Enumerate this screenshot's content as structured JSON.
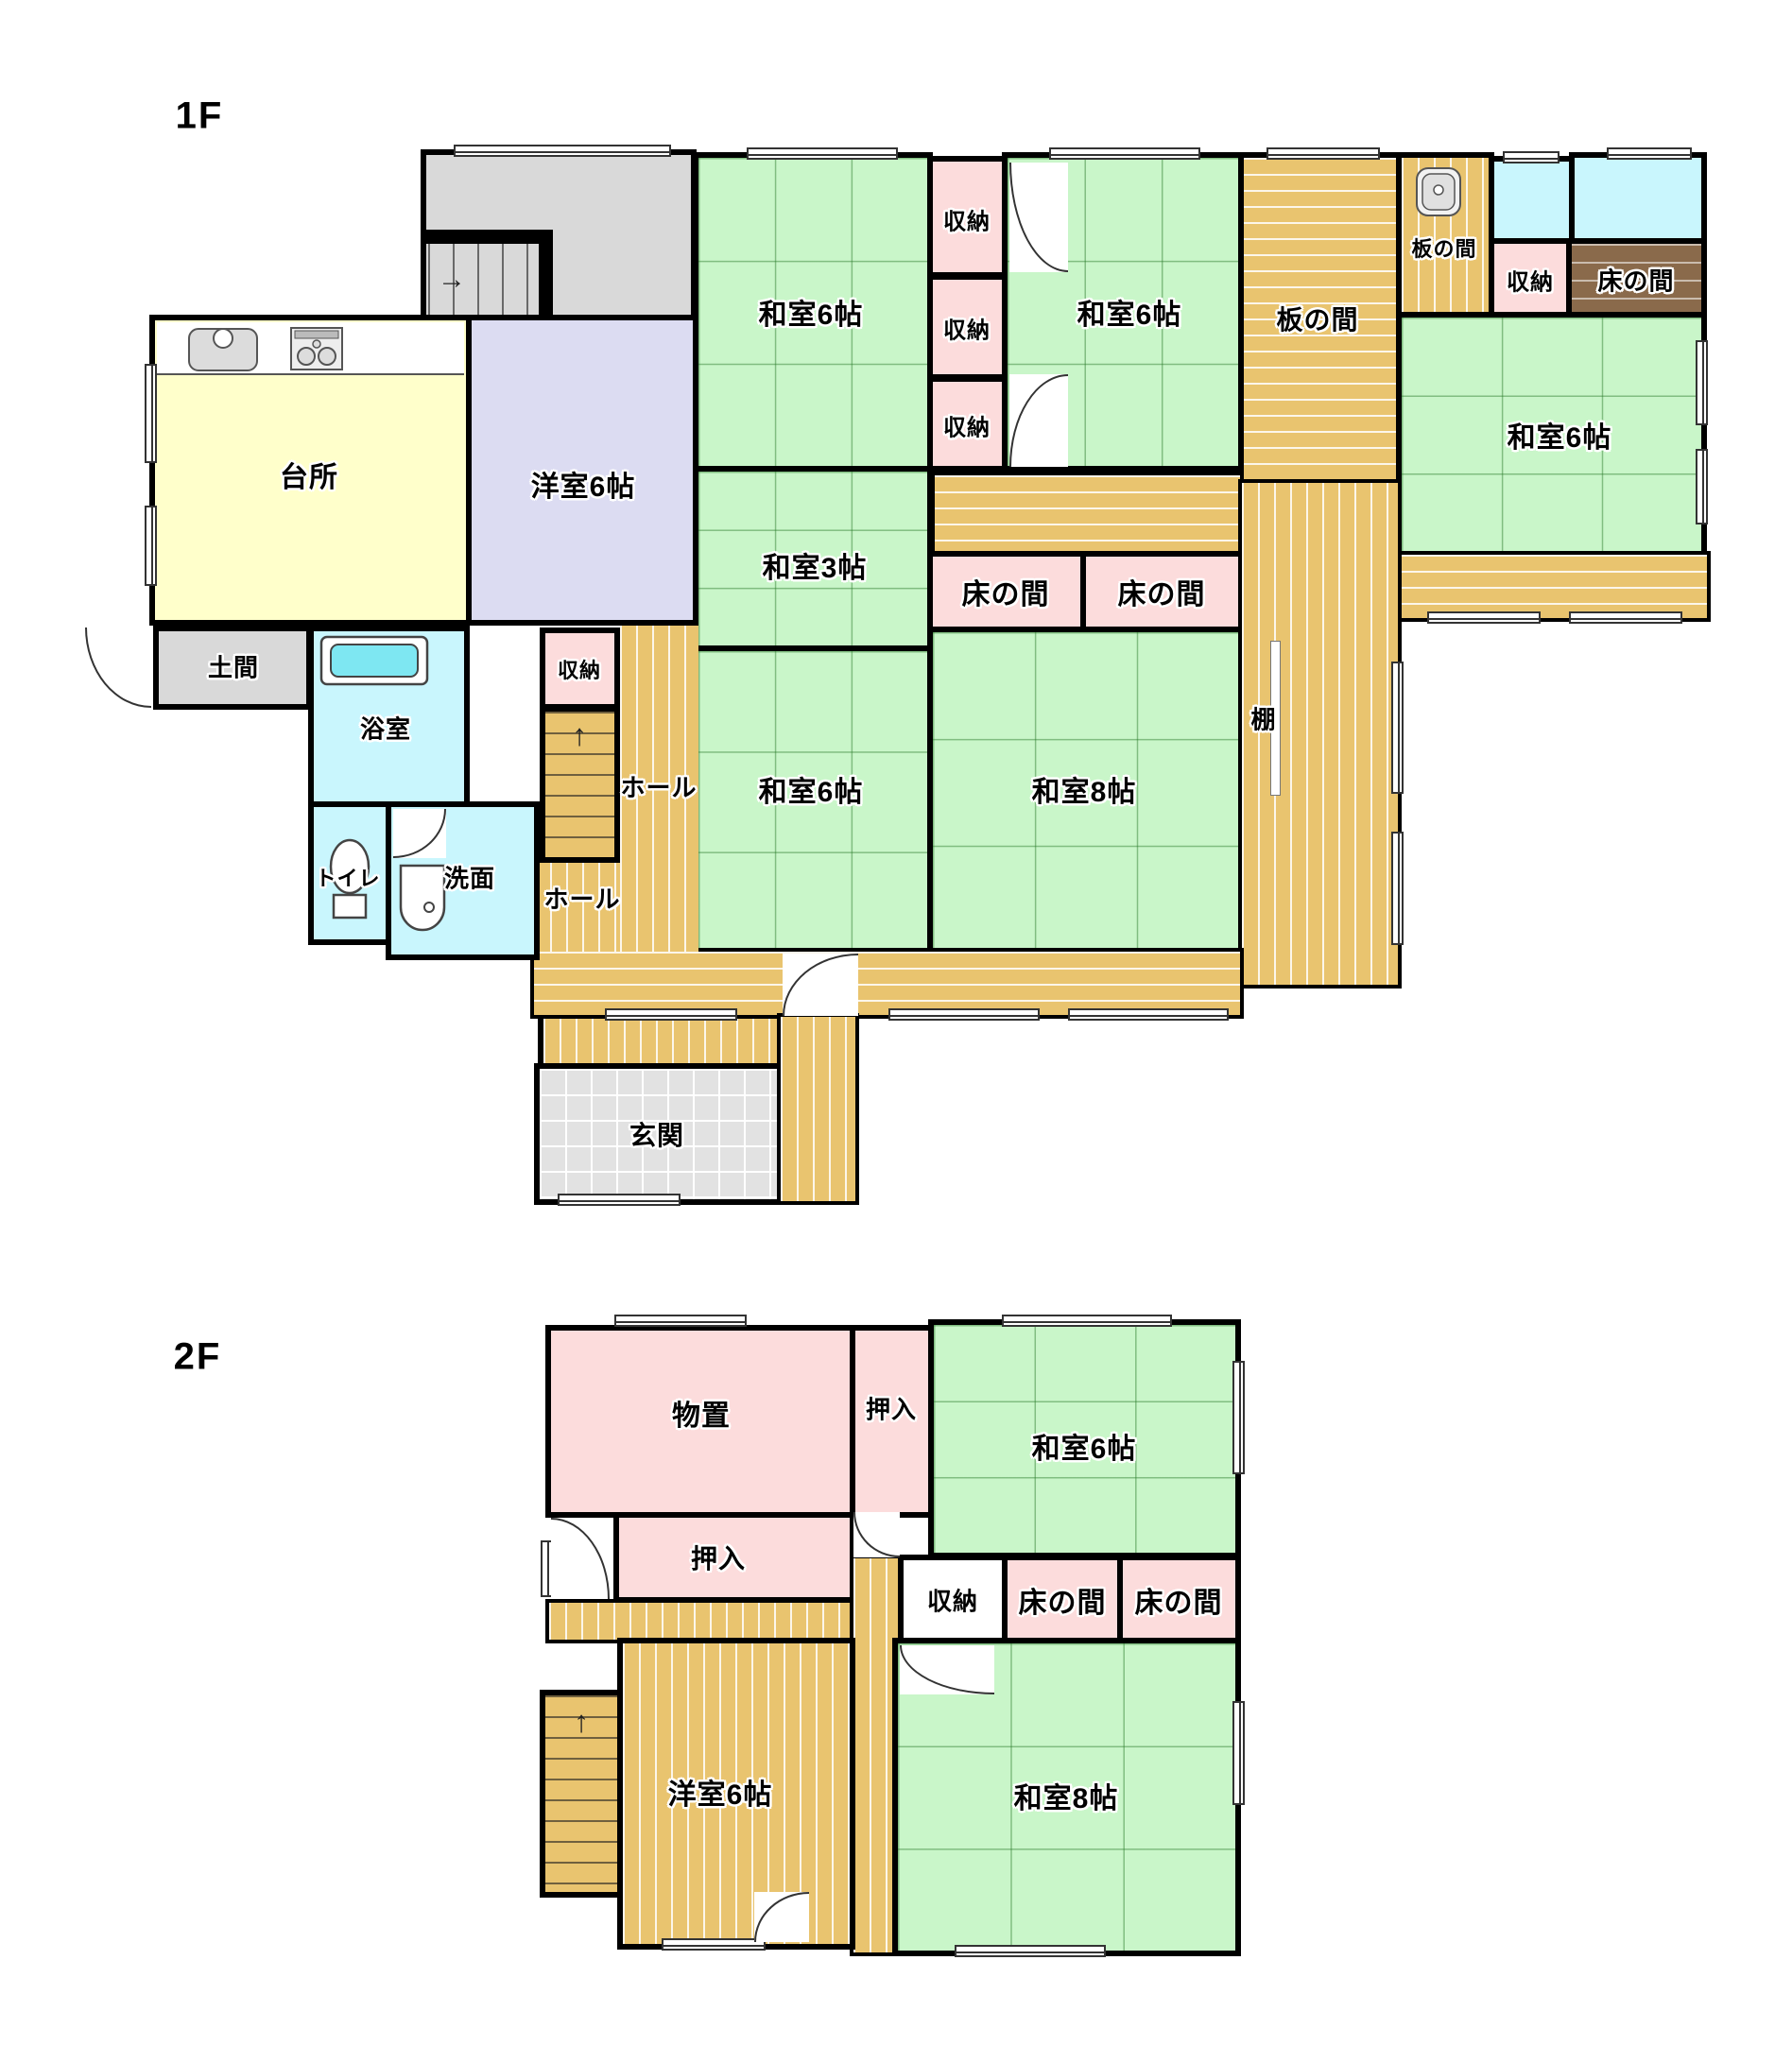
{
  "f1": {
    "floor_label": "1F",
    "kitchen": "台所",
    "western6": "洋室6帖",
    "tatami6_nw": "和室6帖",
    "tatami6_n": "和室6帖",
    "tatami6_e": "和室6帖",
    "tatami6_c": "和室6帖",
    "tatami3": "和室3帖",
    "tatami8": "和室8帖",
    "closet_a": "収納",
    "closet_b": "収納",
    "closet_c": "収納",
    "closet_tr": "収納",
    "closet_stairs": "収納",
    "itanoma_big": "板の間",
    "itanoma_small": "板の間",
    "tokonoma_brown": "床の間",
    "tokonoma_1": "床の間",
    "tokonoma_2": "床の間",
    "shelf": "棚",
    "hall_a": "ホール",
    "hall_b": "ホール",
    "doma": "土間",
    "bath": "浴室",
    "toilet": "トイレ",
    "washroom": "洗面",
    "entrance": "玄関"
  },
  "f2": {
    "floor_label": "2F",
    "storage": "物置",
    "oshiire_a": "押入",
    "oshiire_b": "押入",
    "tatami6": "和室6帖",
    "closet": "収納",
    "tokonoma_1": "床の間",
    "tokonoma_2": "床の間",
    "western6": "洋室6帖",
    "tatami8": "和室8帖"
  },
  "arrows": {
    "up": "↑",
    "right": "→"
  },
  "icons": {
    "kitchen_sink": "kitchen-sink",
    "gas_stove": "gas-stove",
    "small_sink": "hand-wash-sink",
    "bathtub": "bathtub",
    "toilet_bowl": "toilet-bowl",
    "wash_basin": "wash-basin"
  },
  "colors": {
    "tatami_green": "#c9f6c9",
    "wood_tan": "#e9c46f",
    "closet_pink": "#fcdcdc",
    "water_cyan": "#c9f6fd",
    "western_lavender": "#dcdcf2",
    "kitchen_yellow": "#ffffcb",
    "hall_gray": "#d9d9d9",
    "tile_gray": "#e2e2e2",
    "tokonoma_brown": "#8a6a4b",
    "shelf_beige": "#d6cdbf",
    "wall_black": "#000000"
  }
}
